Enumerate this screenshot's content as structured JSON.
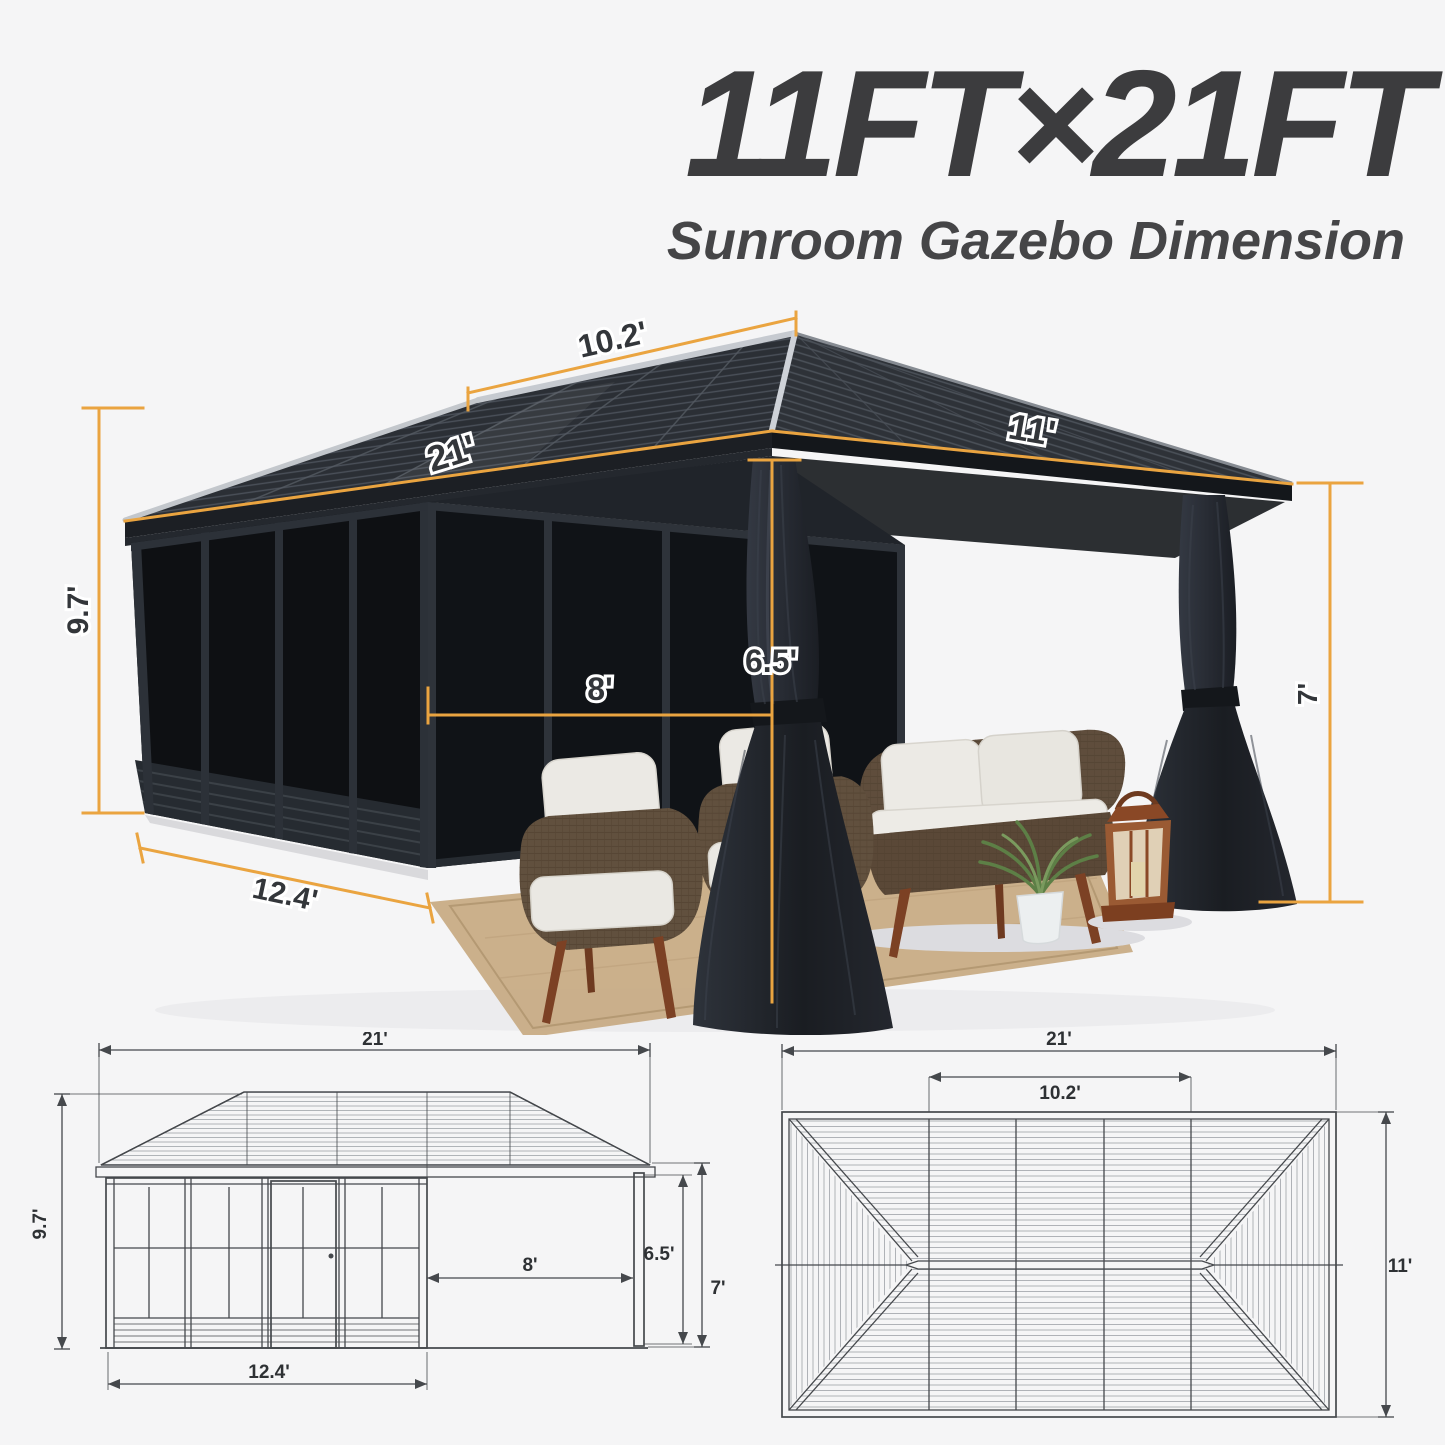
{
  "header": {
    "title": "11FT×21FT",
    "subtitle": "Sunroom Gazebo Dimension"
  },
  "photo": {
    "dims": {
      "ridge_length": "10.2'",
      "roof_length": "21'",
      "roof_width": "11'",
      "peak_height": "9.7'",
      "opening_width": "8'",
      "post_height": "6.5'",
      "eave_height": "7'",
      "sunroom_length": "12.4'"
    }
  },
  "elevation": {
    "dims": {
      "total_length": "21'",
      "peak_height": "9.7'",
      "sunroom_length": "12.4'",
      "opening_width": "8'",
      "post_height": "6.5'",
      "eave_height": "7'"
    }
  },
  "roofplan": {
    "dims": {
      "roof_length": "21'",
      "ridge_length": "10.2'",
      "roof_width": "11'"
    }
  },
  "colors": {
    "accent": "#EAA440",
    "label": "#33363A",
    "drawing_line": "#45484C",
    "background": "#F5F5F6",
    "title_text": "#3C3C3E"
  }
}
